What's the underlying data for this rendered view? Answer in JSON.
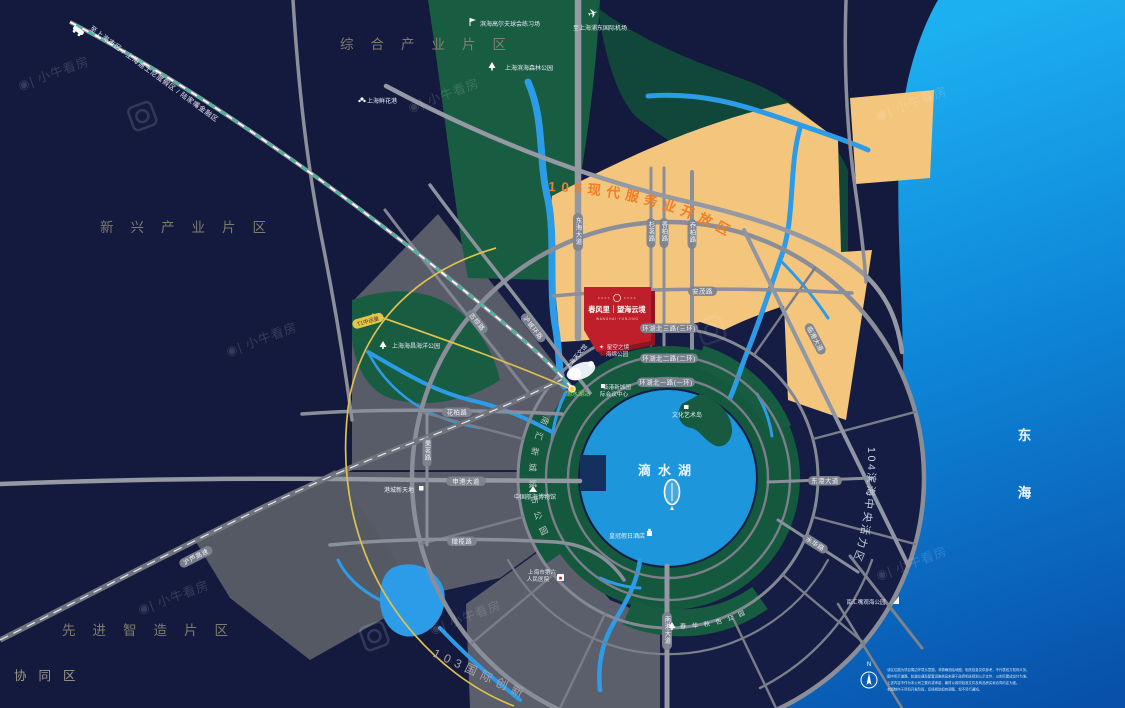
{
  "regions": {
    "comprehensive": "综合产业片区",
    "emerging": "新兴产业片区",
    "advanced": "先进智造片区",
    "zone105": "105现代服务业开放区",
    "zone104": "104滨海中央活力区",
    "zone103_a": "103国际创新",
    "zone103_b": "协同区",
    "east_sea": "东海"
  },
  "project": {
    "name": "春风里｜望海云境",
    "subtitle": "W A N G H A I · Y U N J I N G"
  },
  "transit": {
    "t1": "T1中运量",
    "station": "滴水湖站",
    "to_city": "至上海市区 / 上海迪士尼度假区 / 陆家嘴金融区",
    "to_airport": "至上海浦东国际机场"
  },
  "roads": {
    "donghai_av": "东海大道",
    "shanming": "杉茗路",
    "xiangbai": "香柏路",
    "qiaobai": "乔柏路",
    "anmao": "安茂路",
    "ring3": "环湖北三路(三环)",
    "ring2": "环湖北二路(二环)",
    "ring1": "环湖北一路(一环)",
    "lingang_av": "临港大道",
    "donggang_av": "东港大道",
    "shuihua": "水华路",
    "nangang_av": "南港大道",
    "shengang_av": "申港大道",
    "huabai": "花柏路",
    "ganlan": "橄榄路",
    "guoming": "果茗路",
    "hucheng": "沪城环路",
    "guzong": "古棕路",
    "hulu": "沪芦高速"
  },
  "pois": {
    "airport": "至上海浦东国际机场",
    "golf": "滨海高尔夫球会练习场",
    "forest_park": "上海滨海森林公园",
    "flower_port": "上海鲜花港",
    "ocean_park": "上海海昌海洋公园",
    "planetarium": "上海天文馆",
    "sponge1": "星空之境",
    "sponge2": "海绵公园",
    "conf1": "临港新城国",
    "conf2": "际会议中心",
    "art_island": "文化艺术岛",
    "lake": "滴水湖",
    "hotel": "皇冠假日酒店",
    "gangcheng": "港城新天地",
    "maritime_museum": "中国航海博物馆",
    "hospital1": "上海市第六",
    "hospital2": "人民医院",
    "autumn_park": "春华秋色公园",
    "nanhuizui_park": "南汇嘴观海公园",
    "city_park": "南汇新城城市公园"
  },
  "legend": {
    "north": "N",
    "lines": [
      "·该区位图为项目周边环境示意图，非精确测绘地图，相关信息仅供参考，不代表双方权利义务。",
      "·图中所示道路、轨道交通及配套设施信息来源于政府相关规划公示文件，以实际建成交付为准。",
      "·上述内容不作为本公司之要约或承诺，最终以政府批准文件及商品房买卖合同约定为准。",
      "·本图制作于项目开发阶段，后续规划如有调整，恕不另行通知。"
    ]
  },
  "watermark": {
    "text": "小牛看房"
  }
}
